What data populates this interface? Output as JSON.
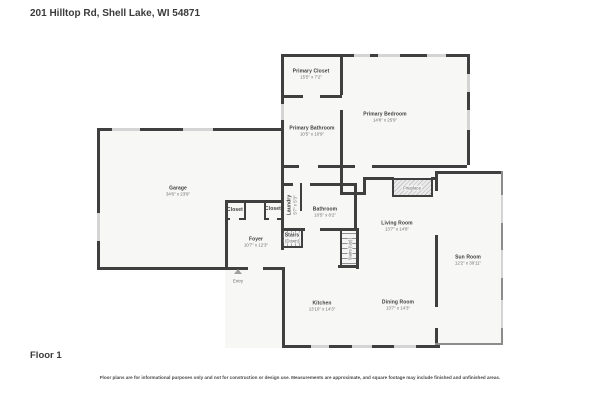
{
  "page": {
    "address": "201 Hilltop Rd, Shell Lake, WI 54871",
    "floor_label": "Floor 1",
    "disclaimer": "Floor plans are for informational purposes only and not for construction or design use. Measurements are approximate, and square footage may include finished and unfinished areas."
  },
  "colors": {
    "wall": "#3f3f3f",
    "sun_room_wall": "#8c8c8c",
    "window": "#d4d4d4",
    "room_fill": "#f7f7f6",
    "label_text": "#3d3d3d",
    "dim_text": "#6e6e6e"
  },
  "rooms": [
    {
      "name": "Primary Closet",
      "dims": "15'5\" x 7'2\""
    },
    {
      "name": "Primary Bathroom",
      "dims": "10'5\" x 10'9\""
    },
    {
      "name": "Primary Bedroom",
      "dims": "14'8\" x 25'9\""
    },
    {
      "name": "Garage",
      "dims": "34'6\" x 23'9\""
    },
    {
      "name": "Closet",
      "dims": ""
    },
    {
      "name": "Closet",
      "dims": ""
    },
    {
      "name": "Laundry",
      "dims": "5'7\" x 5'3\""
    },
    {
      "name": "Bathroom",
      "dims": "10'5\" x 8'2\""
    },
    {
      "name": "Foyer",
      "dims": "10'7\" x 12'3\""
    },
    {
      "name": "Stairs",
      "dims": "(Down)"
    },
    {
      "name": "Stairs (Up)",
      "dims": ""
    },
    {
      "name": "Living Room",
      "dims": "13'7\" x 14'8\""
    },
    {
      "name": "Fireplace",
      "dims": ""
    },
    {
      "name": "Sun Room",
      "dims": "12'2\" x 30'11\""
    },
    {
      "name": "Kitchen",
      "dims": "13'10\" x 14'3\""
    },
    {
      "name": "Dining Room",
      "dims": "13'7\" x 14'3\""
    },
    {
      "name": "Entry",
      "dims": ""
    }
  ]
}
